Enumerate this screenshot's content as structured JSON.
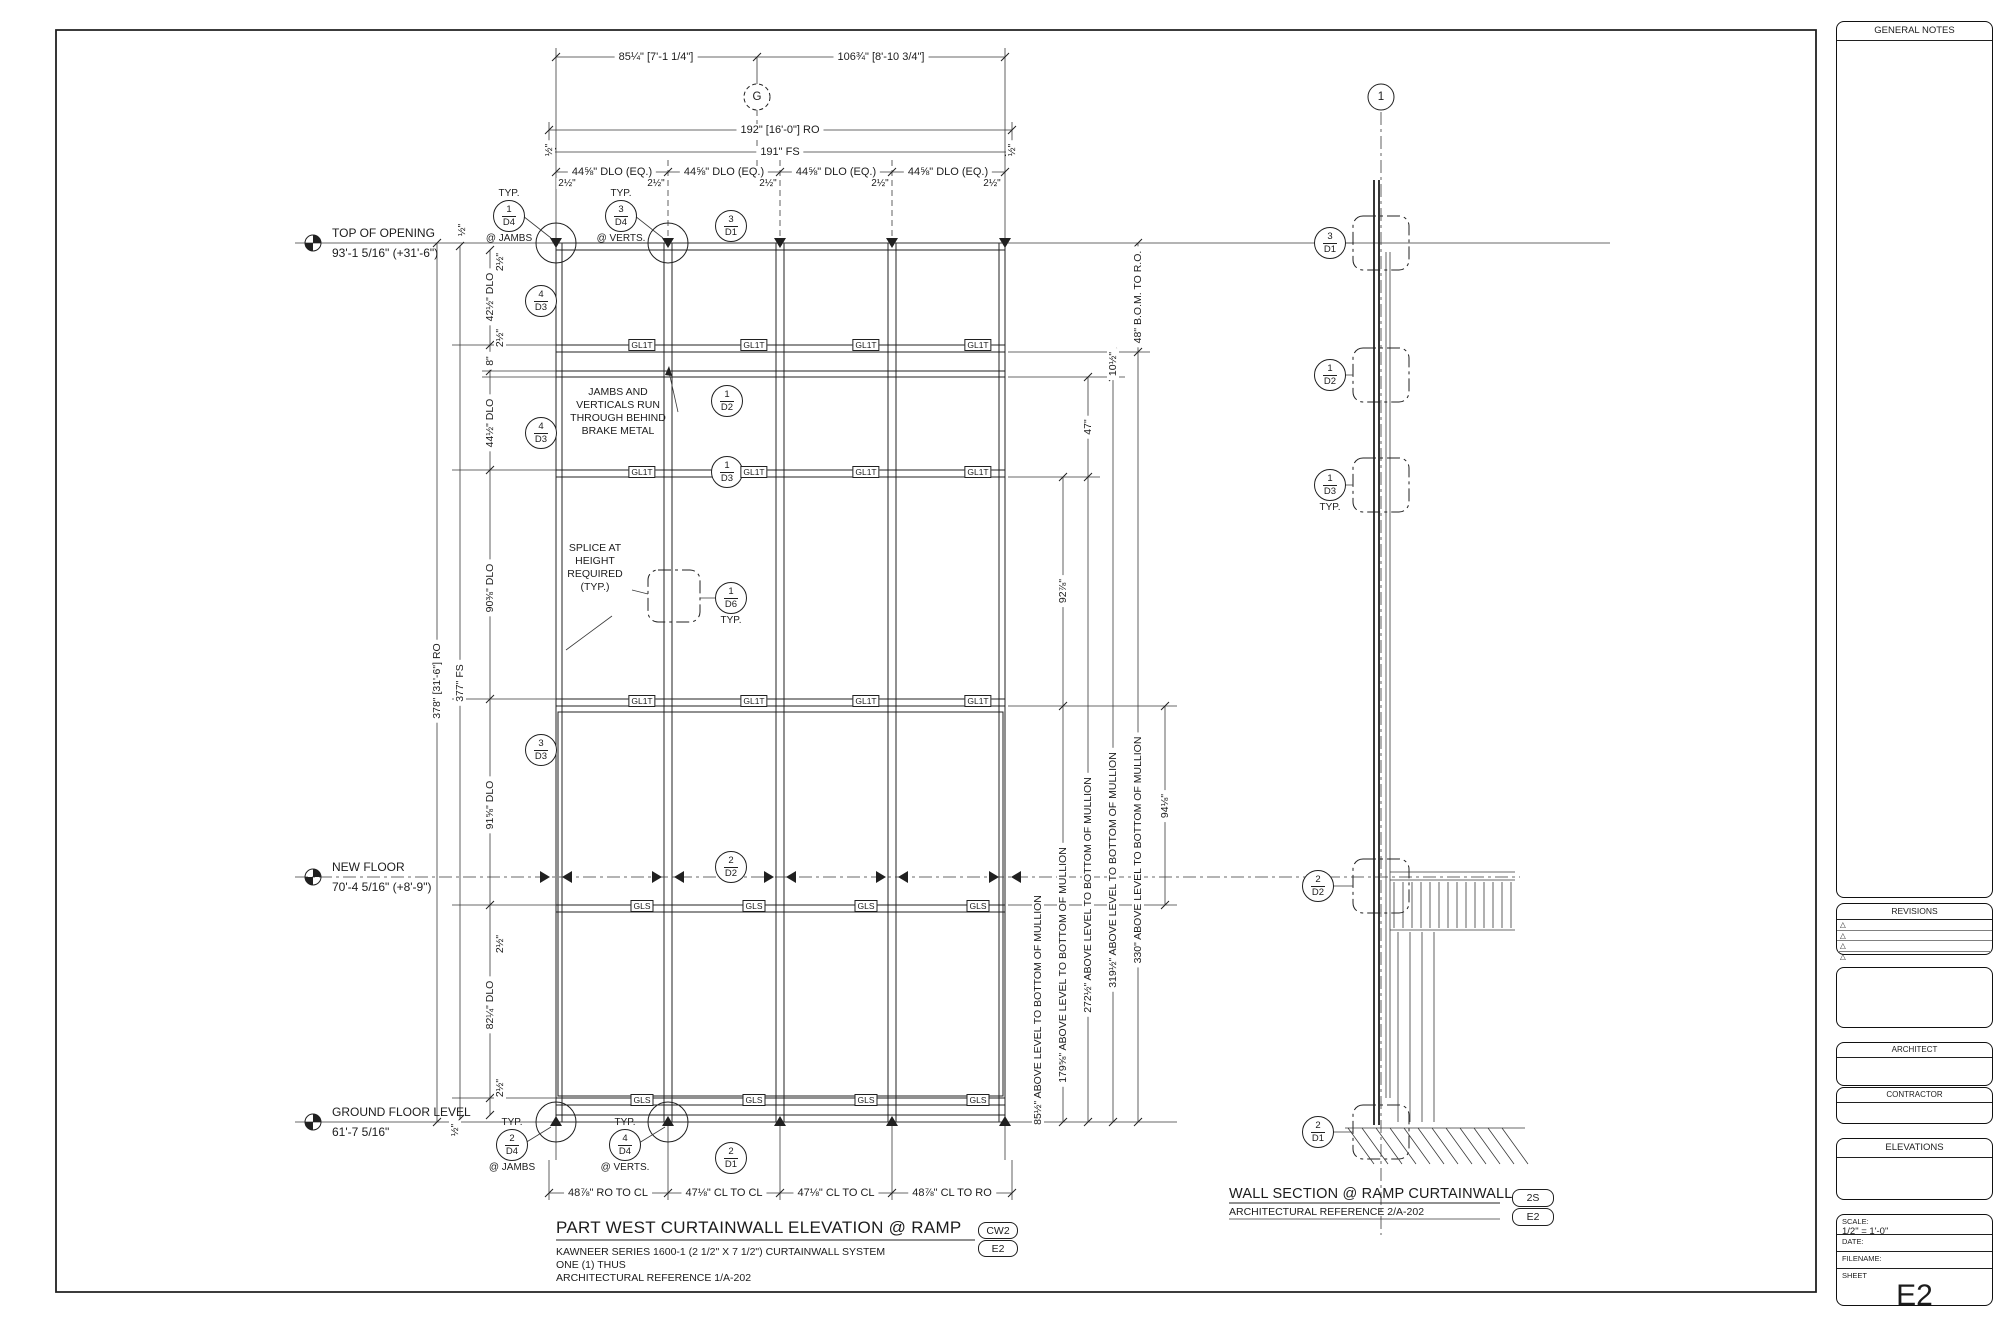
{
  "page": {
    "background": "#ffffff",
    "line_color": "#202020"
  },
  "grid": {
    "g_label": "G",
    "one_label": "1"
  },
  "levels": {
    "top": {
      "name": "TOP OF OPENING",
      "elev": "93'-1 5/16\" (+31'-6\")"
    },
    "new_floor": {
      "name": "NEW FLOOR",
      "elev": "70'-4 5/16\" (+8'-9\")"
    },
    "ground": {
      "name": "GROUND FLOOR LEVEL",
      "elev": "61'-7 5/16\""
    }
  },
  "top_dims": {
    "seg_left": "85¼\" [7'-1 1/4\"]",
    "seg_right": "106¾\" [8'-10 3/4\"]",
    "ro": "192\" [16'-0\"] RO",
    "fs": "191\" FS",
    "bay_dlo": "44⅝\" DLO (EQ.)",
    "half": "½\"",
    "mull": "2½\""
  },
  "left_dims": {
    "ro": "378\" [31'-6\"] RO",
    "fs": "377\" FS",
    "dlo1": "42½\" DLO",
    "d8": "8\"",
    "dlo2": "44½\" DLO",
    "dlo3": "90⅜\" DLO",
    "dlo4": "91⅝\" DLO",
    "dlo5": "82¼\" DLO"
  },
  "right_dims": {
    "bom": "48\" B.O.M. TO R.O.",
    "d105": "10½\"",
    "d47": "47\"",
    "d929": "92⅞\"",
    "d941": "94⅛\"",
    "lvl1": "85½\" ABOVE LEVEL TO BOTTOM OF MULLION",
    "lvl2": "179⅝\" ABOVE LEVEL TO BOTTOM OF MULLION",
    "lvl3": "272½\" ABOVE LEVEL TO BOTTOM OF MULLION",
    "lvl4": "319½\" ABOVE LEVEL TO BOTTOM OF MULLION",
    "lvl5": "330\" ABOVE LEVEL TO BOTTOM OF MULLION"
  },
  "bottom_dims": {
    "s1": "48⅞\" RO TO CL",
    "s2": "47⅛\" CL TO CL",
    "s3": "47⅛\" CL TO CL",
    "s4": "48⅞\" CL TO RO"
  },
  "glass": {
    "gl1t": "GL1T",
    "gls": "GLS"
  },
  "notes": {
    "jambs": {
      "l1": "JAMBS AND",
      "l2": "VERTICALS RUN",
      "l3": "THROUGH BEHIND",
      "l4": "BRAKE METAL"
    },
    "splice": {
      "l1": "SPLICE AT",
      "l2": "HEIGHT",
      "l3": "REQUIRED",
      "l4": "(TYP.)"
    },
    "typ": "TYP.",
    "at_jambs": "@ JAMBS",
    "at_verts": "@ VERTS."
  },
  "callouts": {
    "c1d4": {
      "n": "1",
      "r": "D4"
    },
    "c3d4": {
      "n": "3",
      "r": "D4"
    },
    "c3d1": {
      "n": "3",
      "r": "D1"
    },
    "c4d3": {
      "n": "4",
      "r": "D3"
    },
    "c1d2": {
      "n": "1",
      "r": "D2"
    },
    "c1d3": {
      "n": "1",
      "r": "D3"
    },
    "c1d6": {
      "n": "1",
      "r": "D6"
    },
    "c3d3": {
      "n": "3",
      "r": "D3"
    },
    "c2d2": {
      "n": "2",
      "r": "D2"
    },
    "c2d1": {
      "n": "2",
      "r": "D1"
    },
    "c2d4": {
      "n": "2",
      "r": "D4"
    },
    "c4d4": {
      "n": "4",
      "r": "D4"
    }
  },
  "titles": {
    "elevation": {
      "title": "PART WEST CURTAINWALL ELEVATION @ RAMP",
      "sub1": "KAWNEER SERIES 1600-1 (2 1/2\" X 7 1/2\") CURTAINWALL SYSTEM",
      "sub2": "ONE (1) THUS",
      "sub3": "ARCHITECTURAL REFERENCE 1/A-202",
      "tag1": "CW2",
      "tag2": "E2"
    },
    "section": {
      "title": "WALL SECTION @ RAMP CURTAINWALL",
      "sub1": "ARCHITECTURAL REFERENCE 2/A-202",
      "tag1": "2S",
      "tag2": "E2"
    }
  },
  "titleblock": {
    "general_notes": "GENERAL NOTES",
    "revisions": "REVISIONS",
    "rev_symbol": "△",
    "architect": "ARCHITECT",
    "contractor": "CONTRACTOR",
    "elevations": "ELEVATIONS",
    "scale_label": "SCALE:",
    "scale_value": "1/2\" = 1'-0\"",
    "date_label": "DATE:",
    "filename_label": "FILENAME:",
    "sheet_label": "SHEET",
    "sheet_number": "E2"
  }
}
